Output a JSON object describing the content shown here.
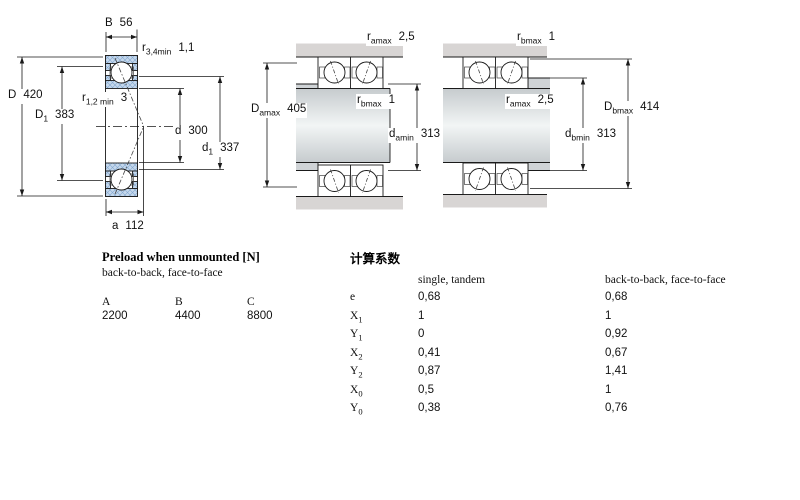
{
  "dims": {
    "B": {
      "base": "B",
      "sub": "",
      "value": "56"
    },
    "r34": {
      "base": "r",
      "sub": "3,4min",
      "value": "1,1"
    },
    "D": {
      "base": "D",
      "sub": "",
      "value": "420"
    },
    "D1": {
      "base": "D",
      "sub": "1",
      "value": "383"
    },
    "r12": {
      "base": "r",
      "sub": "1,2 min",
      "value": "3"
    },
    "d": {
      "base": "d",
      "sub": "",
      "value": "300"
    },
    "d1": {
      "base": "d",
      "sub": "1",
      "value": "337"
    },
    "a": {
      "base": "a",
      "sub": "",
      "value": "112"
    },
    "ramax_a": {
      "base": "r",
      "sub": "amax",
      "value": "2,5"
    },
    "rbmax_a": {
      "base": "r",
      "sub": "bmax",
      "value": "1"
    },
    "Damax": {
      "base": "D",
      "sub": "amax",
      "value": "405"
    },
    "damin": {
      "base": "d",
      "sub": "amin",
      "value": "313"
    },
    "rbmax_b": {
      "base": "r",
      "sub": "bmax",
      "value": "1"
    },
    "ramax_b": {
      "base": "r",
      "sub": "amax",
      "value": "2,5"
    },
    "Dbmax": {
      "base": "D",
      "sub": "bmax",
      "value": "414"
    },
    "dbmin": {
      "base": "d",
      "sub": "bmin",
      "value": "313"
    }
  },
  "preload": {
    "title": "Preload when unmounted [N]",
    "subtitle": "back-to-back, face-to-face",
    "columns": [
      "A",
      "B",
      "C"
    ],
    "values": [
      "2200",
      "4400",
      "8800"
    ]
  },
  "factors": {
    "title": "计算系数",
    "col_single": "single, tandem",
    "col_b2b": "back-to-back, face-to-face",
    "rows": [
      {
        "base": "e",
        "sub": "",
        "single": "0,68",
        "b2b": "0,68"
      },
      {
        "base": "X",
        "sub": "1",
        "single": "1",
        "b2b": "1"
      },
      {
        "base": "Y",
        "sub": "1",
        "single": "0",
        "b2b": "0,92"
      },
      {
        "base": "X",
        "sub": "2",
        "single": "0,41",
        "b2b": "0,67"
      },
      {
        "base": "Y",
        "sub": "2",
        "single": "0,87",
        "b2b": "1,41"
      },
      {
        "base": "X",
        "sub": "0",
        "single": "0,5",
        "b2b": "1"
      },
      {
        "base": "Y",
        "sub": "0",
        "single": "0,38",
        "b2b": "0,76"
      }
    ]
  }
}
